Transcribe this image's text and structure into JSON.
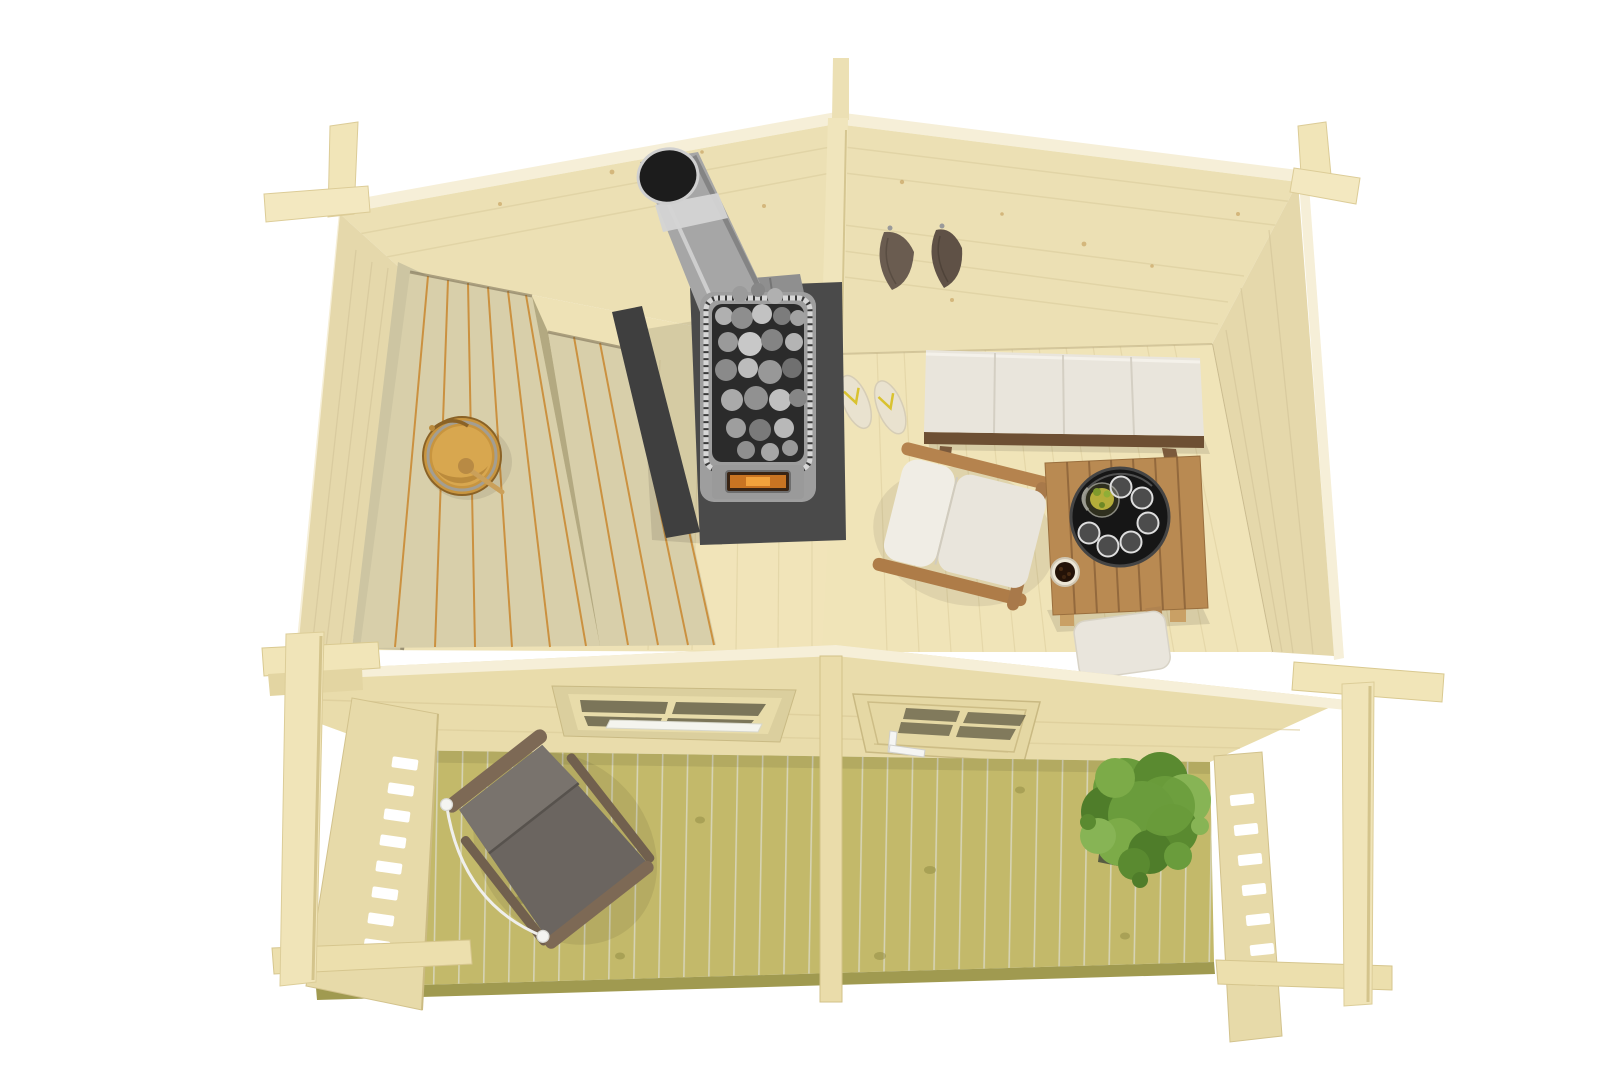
{
  "scene": {
    "description": "Top-down cutaway 3D product render of a wooden log-cabin sauna with a front terrace, shown on a plain white background",
    "view": "birds-eye cutaway, roof removed",
    "background": "#ffffff"
  },
  "colors": {
    "bg": "#ffffff",
    "wallTop": "#f6efd8",
    "wallFace": "#ece0b4",
    "wallFaceSide": "#e5d8ab",
    "plankLine": "#d9cb9b",
    "knotBrown": "#bc8d44",
    "floorSauna": "#eee2b6",
    "floorLounge": "#f0e4b8",
    "partition": "#f0e5bc",
    "benchWood": "#d8cfaa",
    "benchBackrest": "#cdc5a2",
    "benchGlow": "#c9872e",
    "bucketWood": "#c8953f",
    "bucketInner": "#d8a74f",
    "steelTube": "#a6a6a6",
    "steelBody": "#9e9e9e",
    "shieldDark": "#4a4a4a",
    "stoneDark": "#2b2b2b",
    "fireGlow": "#c97422",
    "fireCore": "#f2a23c",
    "towelBrown": "#6a5c50",
    "towelBrown2": "#5f5146",
    "slipperCream": "#e9e2cf",
    "slipperStrap": "#d9c22f",
    "cushionWhite": "#e9e5dc",
    "cushionBright": "#f0ede5",
    "sofaFrame": "#6d4f33",
    "teakWood": "#b98a52",
    "teakLeg": "#c9a065",
    "trayBlack": "#161616",
    "drinkOlive": "#b4ad3a",
    "glassGray": "#c9c9c9",
    "bowlRim": "#ece5d4",
    "berryDark": "#241308",
    "frontWall": "#e9dcab",
    "glassDark": "#57533e",
    "sillWhite": "#f4f4ee",
    "handleWhite": "#f5f5f3",
    "beamWood": "#f1e5b8",
    "postWood": "#f0e4b8",
    "fenceWood": "#e7daa9",
    "railWood": "#ecdfad",
    "deckWood": "#c3b96a",
    "deckEdge": "#a09a50",
    "chairFabric": "#6b6560",
    "chairFabricLight": "#79736d",
    "chairFrame": "#7d6955",
    "ropeWhite": "#efefec",
    "plantGreen": "#6a9c3c",
    "plantDark": "#4f7d2a",
    "plantLight": "#87b455"
  },
  "objects": {
    "sauna_room": [
      "tiered slatted benches with warm back-light",
      "wooden bucket with ladle",
      "wood-burning stove filled with stones",
      "stainless-steel chimney",
      "dark heat shield"
    ],
    "lounge_room": [
      "two brown towels on wall hooks",
      "pair of cream slippers",
      "daybed with white cushions",
      "wooden armchair with white cushions",
      "slatted teak coffee table",
      "round black tray with pitcher and six glasses",
      "small bowl of berries",
      "stool with white cushion"
    ],
    "front_wall": [
      "four-pane window with white sill",
      "glazed door with white handle"
    ],
    "terrace": [
      "green-treated deck boards",
      "grey sling lounge chair with white cord",
      "leafy green plant",
      "slatted privacy fences left and right",
      "three support posts",
      "corner log joints"
    ]
  }
}
